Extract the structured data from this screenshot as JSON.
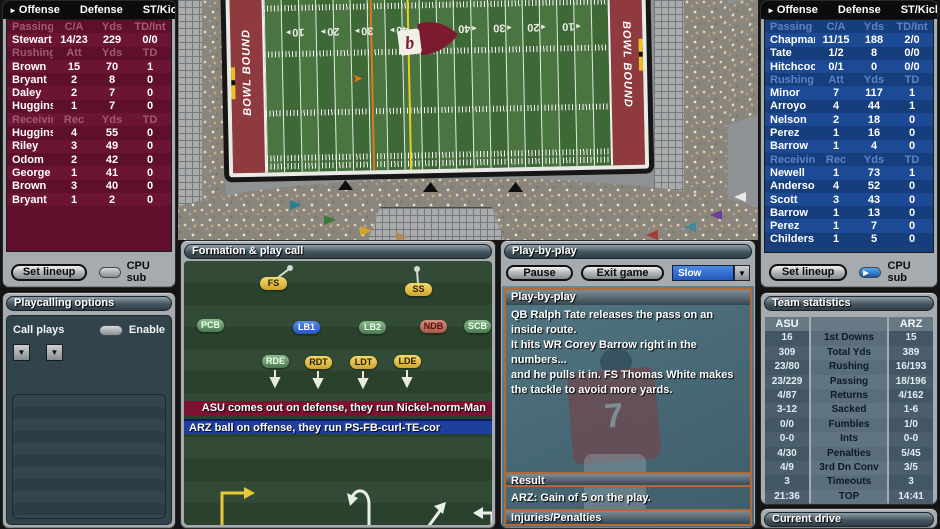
{
  "team_left": {
    "tabs": [
      "Offense",
      "Defense",
      "ST/Kick"
    ],
    "rows": [
      {
        "cells": [
          "Passing",
          "C/A",
          "Yds",
          "TD/Int"
        ],
        "header": true
      },
      {
        "cells": [
          "Stewart",
          "14/23",
          "229",
          "0/0"
        ]
      },
      {
        "cells": [
          "Rushing",
          "Att",
          "Yds",
          "TD"
        ],
        "header": true
      },
      {
        "cells": [
          "Brown",
          "15",
          "70",
          "1"
        ]
      },
      {
        "cells": [
          "Bryant",
          "2",
          "8",
          "0"
        ]
      },
      {
        "cells": [
          "Daley",
          "2",
          "7",
          "0"
        ]
      },
      {
        "cells": [
          "Huggins",
          "1",
          "7",
          "0"
        ]
      },
      {
        "cells": [
          "Receiving",
          "Rec",
          "Yds",
          "TD"
        ],
        "header": true
      },
      {
        "cells": [
          "Huggins",
          "4",
          "55",
          "0"
        ]
      },
      {
        "cells": [
          "Riley",
          "3",
          "49",
          "0"
        ]
      },
      {
        "cells": [
          "Odom",
          "2",
          "42",
          "0"
        ]
      },
      {
        "cells": [
          "George",
          "1",
          "41",
          "0"
        ]
      },
      {
        "cells": [
          "Brown",
          "3",
          "40",
          "0"
        ]
      },
      {
        "cells": [
          "Bryant",
          "1",
          "2",
          "0"
        ]
      }
    ],
    "set_lineup": "Set lineup",
    "cpu_sub": "CPU sub"
  },
  "team_right": {
    "tabs": [
      "Offense",
      "Defense",
      "ST/Kick"
    ],
    "rows": [
      {
        "cells": [
          "Passing",
          "C/A",
          "Yds",
          "TD/Int"
        ],
        "header": true
      },
      {
        "cells": [
          "Chapman",
          "11/15",
          "188",
          "2/0"
        ]
      },
      {
        "cells": [
          "Tate",
          "1/2",
          "8",
          "0/0"
        ]
      },
      {
        "cells": [
          "Hitchcock",
          "0/1",
          "0",
          "0/0"
        ]
      },
      {
        "cells": [
          "Rushing",
          "Att",
          "Yds",
          "TD"
        ],
        "header": true
      },
      {
        "cells": [
          "Minor",
          "7",
          "117",
          "1"
        ]
      },
      {
        "cells": [
          "Arroyo",
          "4",
          "44",
          "1"
        ]
      },
      {
        "cells": [
          "Nelson",
          "2",
          "18",
          "0"
        ]
      },
      {
        "cells": [
          "Perez",
          "1",
          "16",
          "0"
        ]
      },
      {
        "cells": [
          "Barrow",
          "1",
          "4",
          "0"
        ]
      },
      {
        "cells": [
          "Receiving",
          "Rec",
          "Yds",
          "TD"
        ],
        "header": true
      },
      {
        "cells": [
          "Newell",
          "1",
          "73",
          "1"
        ]
      },
      {
        "cells": [
          "Anderson",
          "4",
          "52",
          "0"
        ]
      },
      {
        "cells": [
          "Scott",
          "3",
          "43",
          "0"
        ]
      },
      {
        "cells": [
          "Barrow",
          "1",
          "13",
          "0"
        ]
      },
      {
        "cells": [
          "Perez",
          "1",
          "7",
          "0"
        ]
      },
      {
        "cells": [
          "Childers",
          "1",
          "5",
          "0"
        ]
      }
    ],
    "set_lineup": "Set lineup",
    "cpu_sub": "CPU sub"
  },
  "playcalling": {
    "title": "Playcalling options",
    "call_plays": "Call plays",
    "enable": "Enable"
  },
  "formation": {
    "title": "Formation & play call",
    "players": [
      {
        "label": "FS",
        "color": "yellow",
        "x": 76,
        "y": 16
      },
      {
        "label": "SS",
        "color": "yellow",
        "x": 221,
        "y": 22
      },
      {
        "label": "PCB",
        "color": "green",
        "x": 13,
        "y": 58
      },
      {
        "label": "LB1",
        "color": "blue",
        "x": 109,
        "y": 60
      },
      {
        "label": "LB2",
        "color": "green",
        "x": 175,
        "y": 60
      },
      {
        "label": "NDB",
        "color": "red",
        "x": 236,
        "y": 59
      },
      {
        "label": "SCB",
        "color": "green",
        "x": 280,
        "y": 59
      },
      {
        "label": "RDE",
        "color": "green",
        "x": 78,
        "y": 94
      },
      {
        "label": "RDT",
        "color": "yellow",
        "x": 121,
        "y": 95
      },
      {
        "label": "LDT",
        "color": "yellow",
        "x": 166,
        "y": 95
      },
      {
        "label": "LDE",
        "color": "yellow",
        "x": 210,
        "y": 94
      }
    ],
    "defense_banner": "ASU comes out on defense, they run Nickel-norm-Man",
    "offense_banner": "ARZ ball on offense, they run PS-FB-curl-TE-cor"
  },
  "playbyplay": {
    "title": "Play-by-play",
    "pause": "Pause",
    "exit": "Exit game",
    "speed": "Slow",
    "log_title": "Play-by-play",
    "lines": [
      "QB Ralph Tate releases the pass on an inside route.",
      "It hits WR Corey Barrow right in the numbers...",
      "and he pulls it in. FS Thomas White makes the tackle to avoid more yards."
    ],
    "result_title": "Result",
    "result": "ARZ: Gain of 5 on the play.",
    "injuries_title": "Injuries/Penalties",
    "jersey_number": "7"
  },
  "team_stats": {
    "title": "Team statistics",
    "left_team": "ASU",
    "right_team": "ARZ",
    "rows": [
      [
        "16",
        "1st Downs",
        "15"
      ],
      [
        "309",
        "Total Yds",
        "389"
      ],
      [
        "23/80",
        "Rushing",
        "16/193"
      ],
      [
        "23/229",
        "Passing",
        "18/196"
      ],
      [
        "4/87",
        "Returns",
        "4/162"
      ],
      [
        "3-12",
        "Sacked",
        "1-6"
      ],
      [
        "0/0",
        "Fumbles",
        "1/0"
      ],
      [
        "0-0",
        "Ints",
        "0-0"
      ],
      [
        "4/30",
        "Penalties",
        "5/45"
      ],
      [
        "4/9",
        "3rd Dn Conv",
        "3/5"
      ],
      [
        "3",
        "Timeouts",
        "3"
      ],
      [
        "21:36",
        "TOP",
        "14:41"
      ]
    ]
  },
  "current_drive": {
    "title": "Current drive"
  },
  "field": {
    "endzone_text": "BOWL BOUND",
    "numbers": [
      {
        "t": "10",
        "side": "l",
        "x": 56
      },
      {
        "t": "20",
        "side": "l",
        "x": 91
      },
      {
        "t": "30",
        "side": "l",
        "x": 125
      },
      {
        "t": "40",
        "side": "l",
        "x": 160
      },
      {
        "t": "50",
        "side": "c",
        "x": 196
      },
      {
        "t": "40",
        "side": "r",
        "x": 228
      },
      {
        "t": "30",
        "side": "r",
        "x": 263
      },
      {
        "t": "20",
        "side": "r",
        "x": 297
      },
      {
        "t": "10",
        "side": "r",
        "x": 332
      }
    ]
  }
}
